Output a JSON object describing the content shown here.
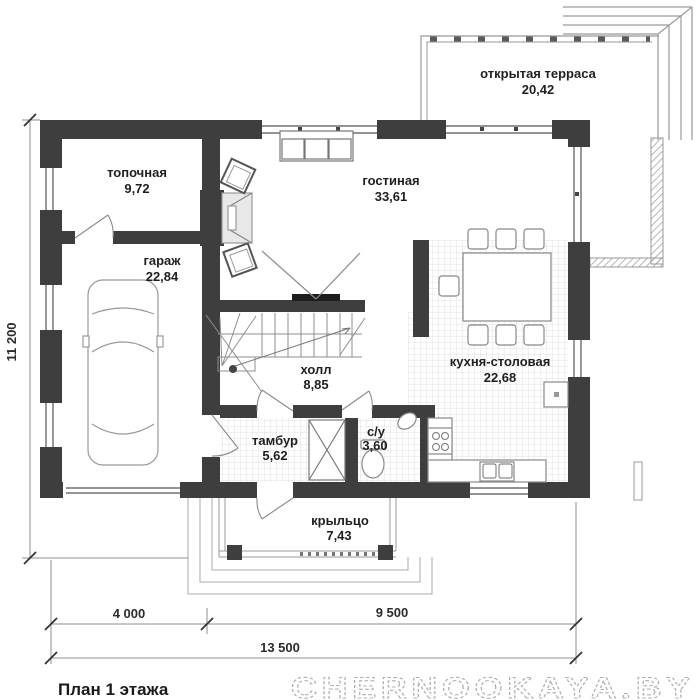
{
  "plan": {
    "title": "План 1 этажа",
    "watermark": "CHERNOOKAYA.BY",
    "rooms": [
      {
        "name": "топочная",
        "area": "9,72"
      },
      {
        "name": "гараж",
        "area": "22,84"
      },
      {
        "name": "гостиная",
        "area": "33,61"
      },
      {
        "name": "открытая терраса",
        "area": "20,42"
      },
      {
        "name": "кухня-столовая",
        "area": "22,68"
      },
      {
        "name": "холл",
        "area": "8,85"
      },
      {
        "name": "тамбур",
        "area": "5,62"
      },
      {
        "name": "с/у",
        "area": "3,60"
      },
      {
        "name": "крыльцо",
        "area": "7,43"
      }
    ],
    "dimensions": {
      "left_total": "11 200",
      "bottom_left": "4 000",
      "bottom_right": "9 500",
      "bottom_total": "13 500"
    },
    "colors": {
      "wall": "#3e3e3e",
      "line": "#8a8a8a",
      "text": "#1f1f1f",
      "watermark": "#b0b0b0"
    }
  }
}
